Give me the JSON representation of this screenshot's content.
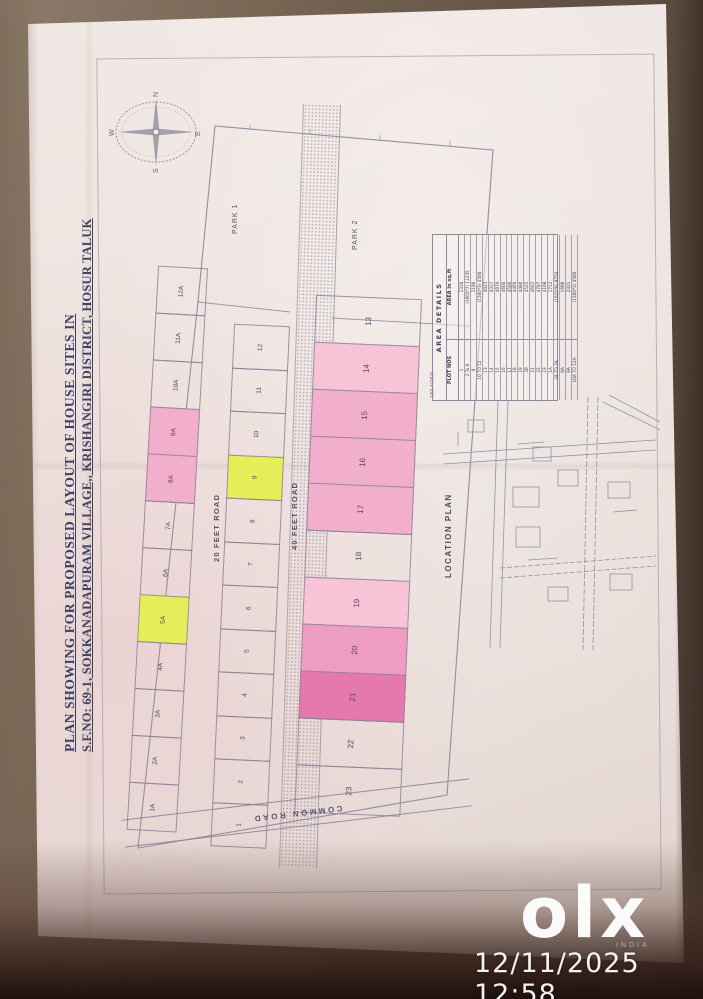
{
  "photo": {
    "timestamp": "12/11/2025 12:58",
    "watermark_brand": "olx",
    "watermark_sub": "INDIA"
  },
  "title": {
    "line1": "PLAN SHOWING FOR PROPOSED LAYOUT OF HOUSE SITES IN",
    "line2": "S.F.NO: 69-1, SOKKANADAPURAM VILLAGE,, KRISHANGIRI DISTRICT, HOSUR TALUK"
  },
  "compass": {
    "north": "N",
    "south": "S",
    "east": "E",
    "west": "W"
  },
  "plan": {
    "road_20": "20 FEET ROAD",
    "road_40": "40 FEET ROAD",
    "common_road": "COMMON ROAD",
    "park_1": "PARK 1",
    "park_2": "PARK 2",
    "boundary_dim": "132.4(157)",
    "left_plots": [
      "12A",
      "11A",
      "10A",
      "9A",
      "8A",
      "7A",
      "6A",
      "5A",
      "4A",
      "3A",
      "2A",
      "1A"
    ],
    "mid_plots": [
      "12",
      "11",
      "10",
      "9",
      "8",
      "7",
      "6",
      "5",
      "4",
      "3",
      "2",
      "1"
    ],
    "right_plots": [
      "13",
      "14",
      "15",
      "16",
      "17",
      "18",
      "19",
      "20",
      "21",
      "22",
      "23"
    ],
    "highlight": {
      "9A": "pink",
      "8A": "pink",
      "5A": "yellow",
      "9": "yellow",
      "14": "pink_light",
      "15": "pink",
      "16": "pink",
      "17": "pink",
      "19": "pink_light",
      "20": "pink_med",
      "21": "pink_dark"
    }
  },
  "area_table": {
    "title": "AREA DETAILS",
    "col1": "PLOT NOS",
    "col2": "AREA in sq.ft",
    "rows": [
      [
        "1",
        "1318"
      ],
      [
        "2 To 8",
        "(1605*7) 11235"
      ],
      [
        "9",
        "2190"
      ],
      [
        "10 TO 12",
        "(1500*3) 4500"
      ],
      [
        "13",
        "4023"
      ],
      [
        "14",
        "4317"
      ],
      [
        "15",
        "4970"
      ],
      [
        "16",
        "4600"
      ],
      [
        "17",
        "4500"
      ],
      [
        "18",
        "4460"
      ],
      [
        "19",
        "4480"
      ],
      [
        "20",
        "4525"
      ],
      [
        "21",
        "4662"
      ],
      [
        "22",
        "4787"
      ],
      [
        "23",
        "4108"
      ],
      [
        "1A",
        "1712"
      ],
      [
        "2A TO 7A",
        "(1625*6) 9750"
      ],
      [
        "8A",
        "1600"
      ],
      [
        "9A",
        "2321"
      ],
      [
        "10A TO 12A",
        "(1500*3) 4500"
      ]
    ]
  },
  "location_plan": {
    "label": "LOCATION PLAN"
  },
  "colors": {
    "pink": "#f2afcb",
    "pink_light": "#f6c3d7",
    "pink_med": "#ef9cc4",
    "pink_dark": "#e678b0",
    "yellow": "#e4ee58",
    "ink": "#3c4160",
    "paper": "#ece3df"
  }
}
